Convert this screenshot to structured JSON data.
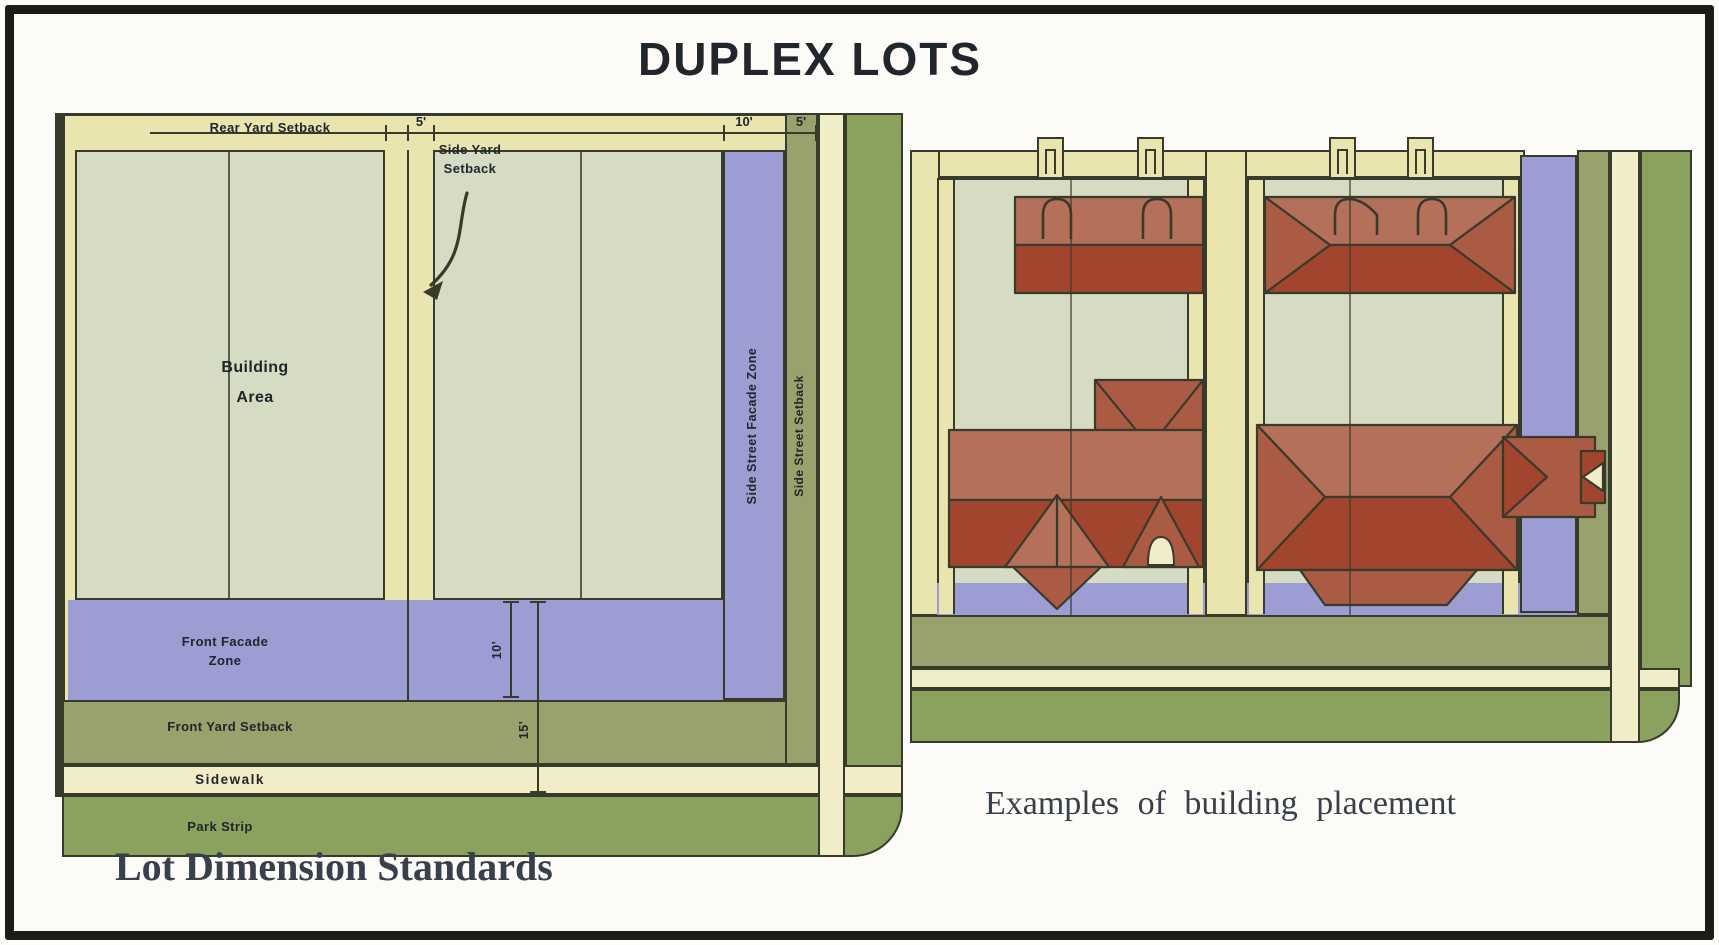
{
  "title": "DUPLEX LOTS",
  "palette": {
    "cream": "#eae5af",
    "sidewalk_cream": "#f0edc8",
    "building_green": "#d6dbc3",
    "facade_purple": "#9b9dd3",
    "setback_olive": "#99a16c",
    "park_green": "#8ba25f",
    "outline": "#383b2c",
    "roof_dark": "#a2452f",
    "roof_mid": "#ab5a43",
    "roof_light": "#b5705a",
    "text_dark": "#21252c",
    "caption_color": "#38404b"
  },
  "lot_dimension_diagram": {
    "caption": "Lot Dimension Standards",
    "labels": {
      "rear_yard_setback": "Rear Yard Setback",
      "side_yard_setback": [
        "Side Yard",
        "Setback"
      ],
      "building_area": [
        "Building",
        "Area"
      ],
      "side_street_facade_zone": "Side Street Facade Zone",
      "side_street_setback": "Side Street Setback",
      "front_facade_zone": [
        "Front Facade",
        "Zone"
      ],
      "front_yard_setback": "Front Yard Setback",
      "sidewalk": "Sidewalk",
      "park_strip": "Park Strip"
    },
    "dimensions": {
      "side_yard_width": "5'",
      "side_street_facade_zone_width": "10'",
      "side_street_setback_width": "5'",
      "front_facade_zone_depth": "10'",
      "front_setback_depth": "15'"
    }
  },
  "placement_diagram": {
    "caption": "Examples of building placement"
  }
}
